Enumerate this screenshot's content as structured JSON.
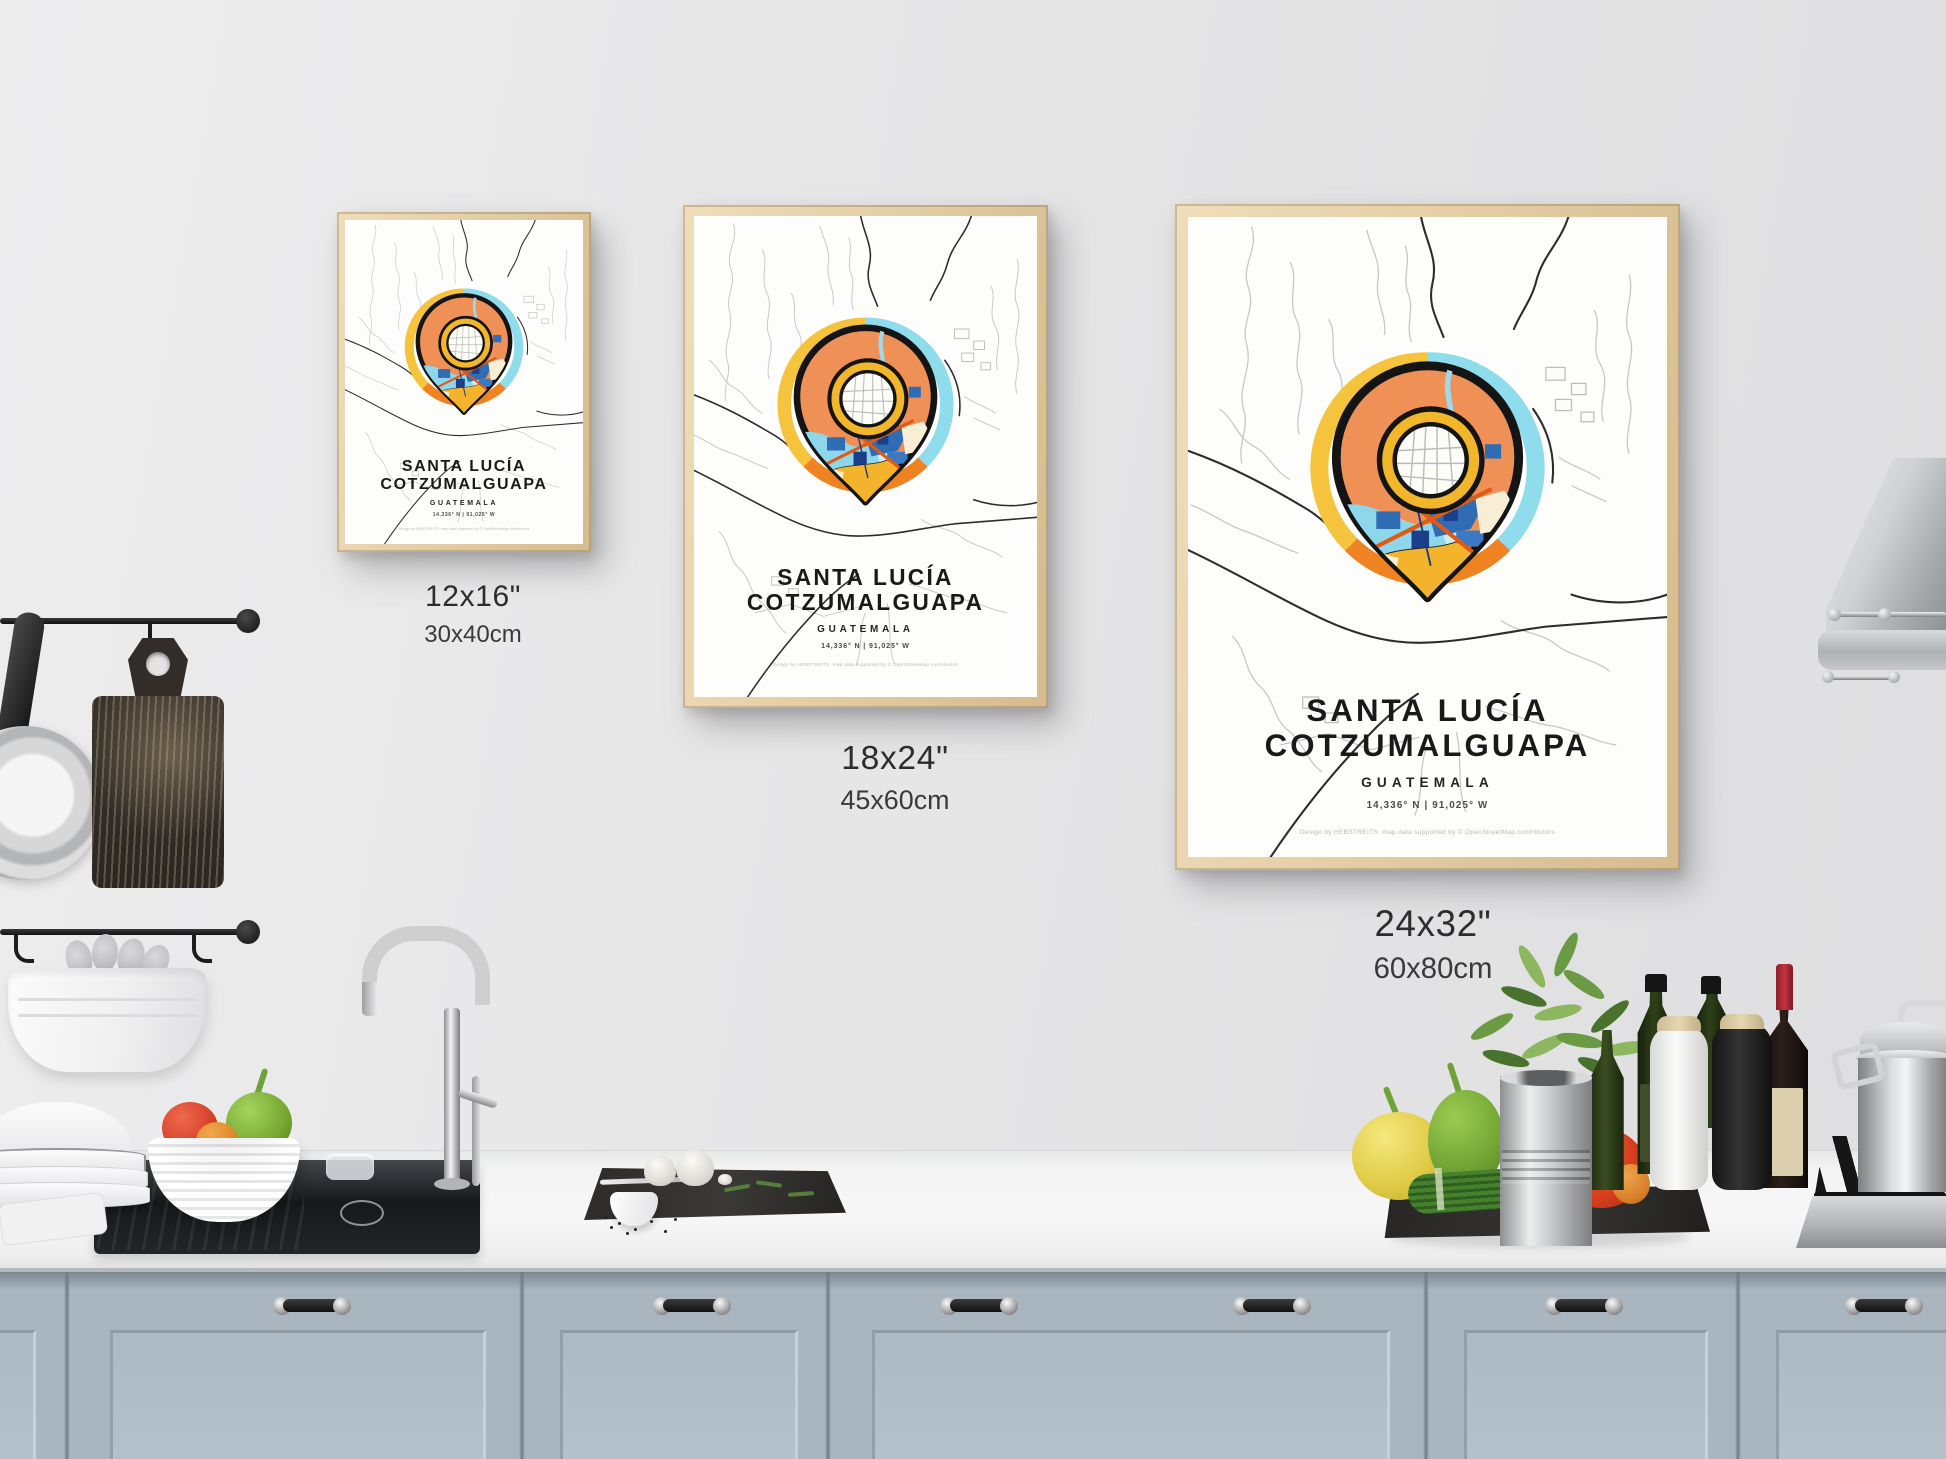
{
  "posters": [
    {
      "id": "poster-12x16",
      "title_line1": "SANTA LUCÍA",
      "title_line2": "COTZUMALGUAPA",
      "subtitle": "GUATEMALA",
      "coordinates": "14,336° N | 91,025° W",
      "credit": "Design by HEBSTREITS, map data supported by © OpenStreetMap contributors",
      "size_in": "12x16\"",
      "size_cm": "30x40cm"
    },
    {
      "id": "poster-18x24",
      "title_line1": "SANTA LUCÍA",
      "title_line2": "COTZUMALGUAPA",
      "subtitle": "GUATEMALA",
      "coordinates": "14,336° N | 91,025° W",
      "credit": "Design by HEBSTREITS, map data supported by © OpenStreetMap contributors",
      "size_in": "18x24\"",
      "size_cm": "45x60cm"
    },
    {
      "id": "poster-24x32",
      "title_line1": "SANTA LUCÍA",
      "title_line2": "COTZUMALGUAPA",
      "subtitle": "GUATEMALA",
      "coordinates": "14,336° N | 91,025° W",
      "credit": "Design by HEBSTREITS, map data supported by © OpenStreetMap contributors",
      "size_in": "24x32\"",
      "size_cm": "60x80cm"
    }
  ],
  "colors": {
    "halo_yellow": "#f6c43c",
    "halo_cyan": "#8edcec",
    "halo_orange": "#ef8321",
    "pin_orange": "#ef9157",
    "map_yellow": "#f3b42c",
    "water_blue": "#2f6cb3",
    "water_cyan": "#96dcec",
    "frame_wood": "#e4cea6",
    "cabinet_blue_gray": "#a9b5bf",
    "wall_gray": "#e7e7e8",
    "counter_white": "#f4f4f5"
  }
}
